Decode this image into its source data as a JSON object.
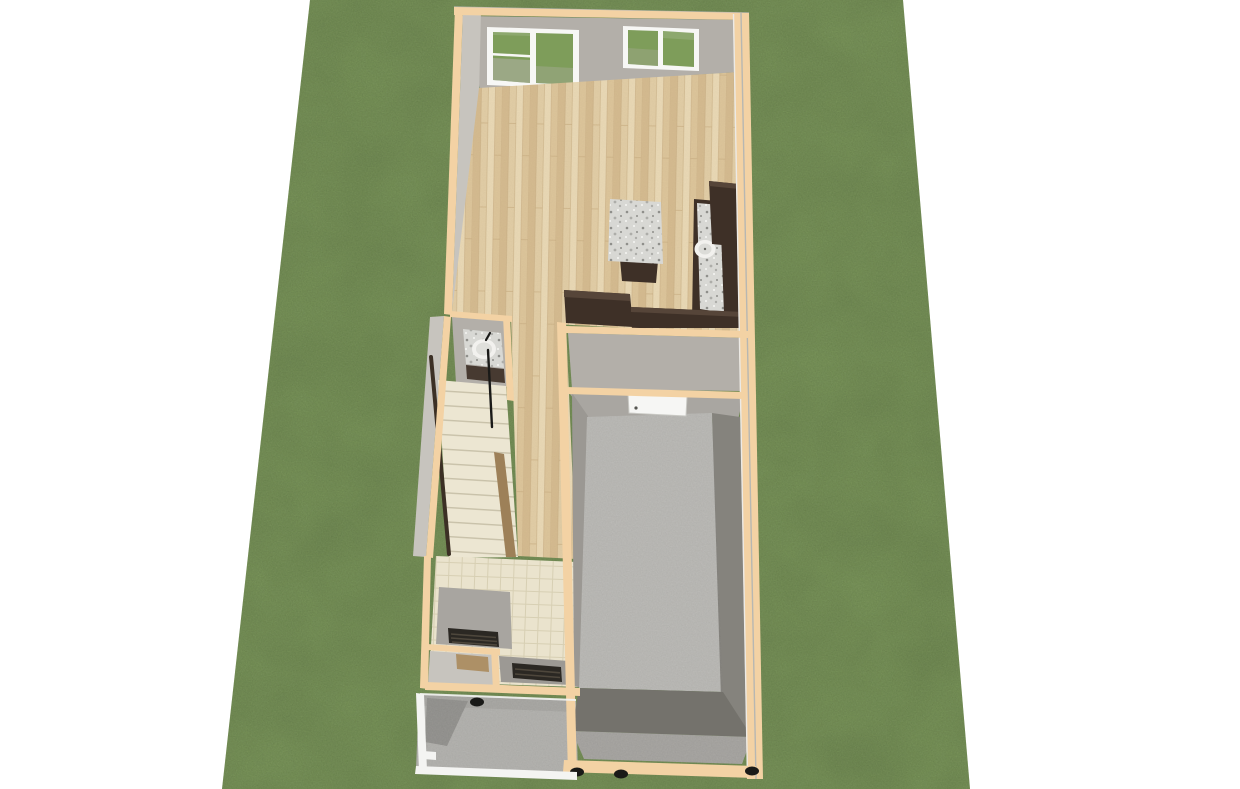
{
  "meta": {
    "image_type": "3d-architectural-rendering",
    "description": "Aerial 3D rendering of a narrow tiny house floor plan on a green grass lot over a white background",
    "view": "top-down three-quarter aerial",
    "background": "#FFFFFF"
  },
  "palette": {
    "grass": "#7E9D5A",
    "wall_cap": "#F3D2A4",
    "wall_face": "#B3AFA9",
    "wall_face_light": "#C7C4BE",
    "wall_face_mid": "#A9A6A1",
    "wall_face_dark": "#9B9893",
    "wood_base": "#E5D0A8",
    "wood_dark": "#D8BE92",
    "wood_mid": "#E0C89D",
    "wood_light": "#EDDCB8",
    "wood_line": "#C9AF82",
    "cabinet_dark": "#3E3027",
    "cabinet_top": "#564539",
    "granite_base": "#D8D8D4",
    "granite_dot_dark": "#8F8F8B",
    "granite_dot_mid": "#ADADA9",
    "granite_dot_light": "#F1F1EE",
    "stair_tread": "#ECE6D2",
    "stair_line": "#C8C1A9",
    "stair_rail": "#3C3025",
    "stair_stringer": "#9D8058",
    "tile_base": "#EAE3CD",
    "tile_line": "#D7CFB3",
    "concrete": "#BDBCB8",
    "concrete_mid": "#A8A6A2",
    "concrete_dark": "#85837D",
    "concrete_darker": "#74726C",
    "porch": "#B5B4B0",
    "porch_shadow": "#94938F",
    "white_trim": "#F4F4F2",
    "window_frame": "#F7F7F5",
    "glass_tint": "#FFFFFF",
    "glass_shade": "#B3B0AA",
    "door_white": "#F6F6F4",
    "door_edge": "#C9C9C4",
    "counter_gray": "#A8A5A0",
    "counter_gray2": "#9C9994",
    "grate_dark": "#2B2823",
    "grate_slat": "#4E473C",
    "closet_floor": "#AD9066",
    "sink_white": "#F2F1EE",
    "black": "#1A1A18",
    "knob_gray": "#555550",
    "edge_gray": "#B7B7B2",
    "edge_light": "#ECEAE6"
  },
  "scene": {
    "lot": {
      "surface": "grass lawn",
      "shape": "perspective trapezoid"
    },
    "rooms": [
      {
        "id": "living-kitchen",
        "floor": "light wood planks"
      },
      {
        "id": "bathroom-nook",
        "floor": "gray"
      },
      {
        "id": "staircase",
        "floor": "cream treads"
      },
      {
        "id": "hallway",
        "floor": "light wood planks"
      },
      {
        "id": "entry",
        "floor": "beige tile"
      },
      {
        "id": "closet",
        "floor": "brown"
      },
      {
        "id": "garage",
        "floor": "concrete"
      },
      {
        "id": "porch",
        "floor": "concrete with white railing"
      }
    ],
    "fixtures": [
      "sliding-glass-door",
      "slider-window",
      "kitchen-island-granite",
      "east-counter-granite-with-round-sink",
      "upper-cabinet",
      "peninsula-counter",
      "vanity-with-round-sink",
      "stair-handrail",
      "stair-stringer",
      "interior-white-door-with-knob",
      "floor-grate-a",
      "floor-grate-b",
      "porch-railing",
      "trailer-wheels"
    ]
  }
}
